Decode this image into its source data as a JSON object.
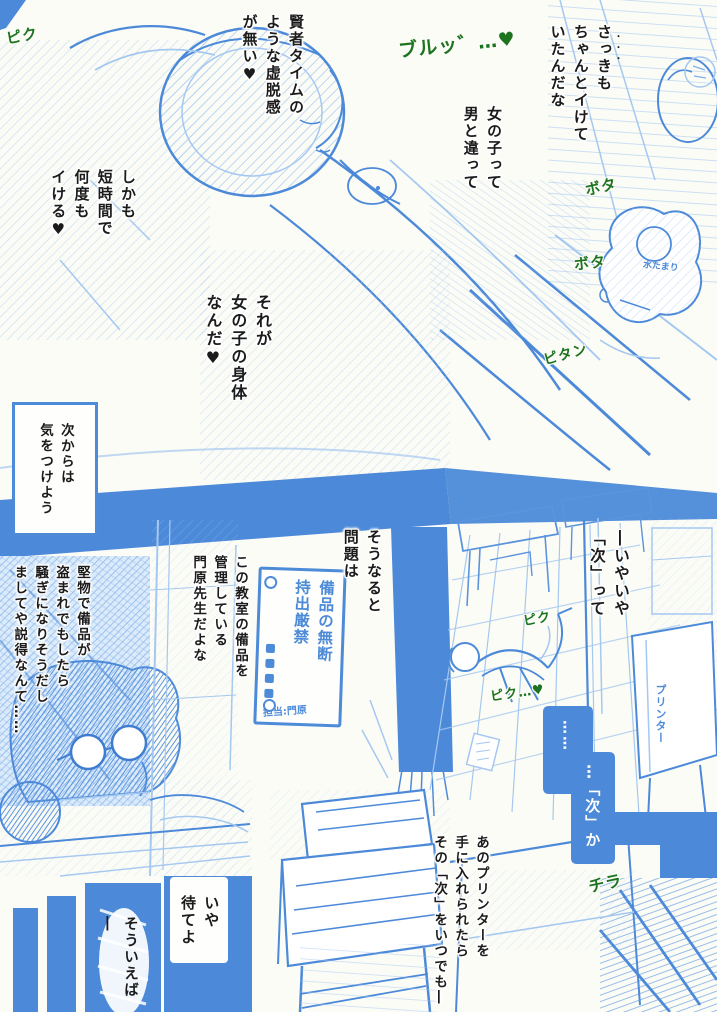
{
  "page": {
    "bg_color": "#fcfcf6",
    "ink_blue": "#4c8ad9",
    "light_blue": "#a5c8f0",
    "sfx_green": "#1e7321",
    "text_color": "#1b1b1b"
  },
  "speech": {
    "sakki": {
      "text": "さっきも\nちゃんとイけて\nいたんだな",
      "emphasis": "・・・"
    },
    "onnanoko": {
      "text": "女の子って\n男と違って"
    },
    "kenja": {
      "text": "賢者タイムの\nような虚脱感\nが無い♥"
    },
    "shikamo": {
      "text": "しかも\n短時間で\n何度も\nイける♥"
    },
    "sorega": {
      "text": "それが\n女の子の身体\nなんだ♥"
    },
    "tsugikara": {
      "text": "次からは\n気をつけよう"
    },
    "sounaruto": {
      "text": "そうなると\n問題は"
    },
    "kono_kyoshitsu": {
      "text": "この教室の備品を\n管理している\n門原先生だよな"
    },
    "katabutsu": {
      "text": "堅物で備品が\n盗まれでもしたら\n騒ぎになりそうだし\nましてや説得なんて……"
    },
    "iyaiya": {
      "text": "―いやいや\n「次」って"
    },
    "monologue_dots": {
      "text": "……"
    },
    "tsugika": {
      "text": "…「次」か"
    },
    "ano_printer": {
      "text": "あのプリンターを\n手に入れられたら\nその「次」をいつでも―"
    },
    "iya_mateyo": {
      "text": "いや\n待てよ"
    },
    "souieba": {
      "text": "そういえば―"
    }
  },
  "sfx": {
    "piku_top": "ピク",
    "buru": "ブルッ゛…♥",
    "bota_1": "ボタ",
    "bota_2": "ボタ",
    "pitan": "ピタン",
    "piku_mid": "ピク",
    "piku_heart": "ピク…♥",
    "chira": "チラ"
  },
  "labels": {
    "sign_title": "備品の無断\n持出厳禁",
    "sign_signature": "担当:門原",
    "puddle": "水たまり",
    "printer": "プリンター"
  }
}
